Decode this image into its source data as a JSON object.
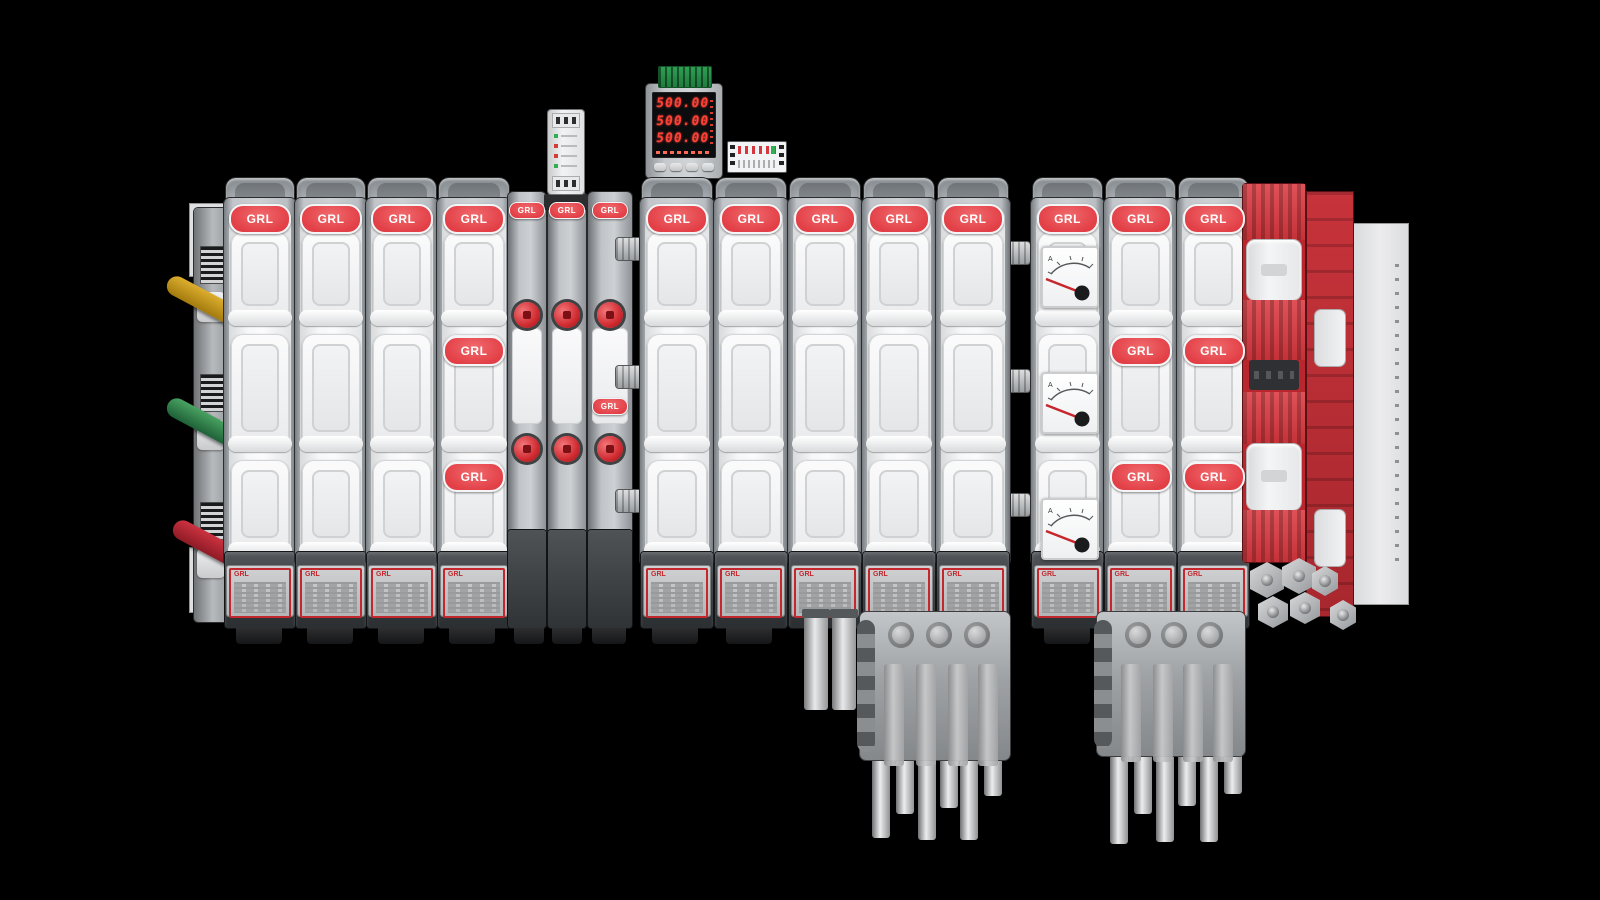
{
  "brand": "GRL",
  "digital_meter": {
    "rows": [
      "500.00",
      "500.00",
      "500.00"
    ]
  },
  "analog_meter": {
    "unit": "A"
  },
  "colors": {
    "background": "#000000",
    "brand_red": "#e23f46",
    "equipment_red": "#c43238",
    "body_white": "#f4f5f6",
    "frame_gray": "#b5b9bd",
    "base_dark": "#3a3d41",
    "display_digits": "#ff4136",
    "terminal_green": "#2f9e53",
    "handle_yellow": "#dcae2e",
    "handle_green": "#49a261",
    "handle_red": "#cc3240"
  }
}
